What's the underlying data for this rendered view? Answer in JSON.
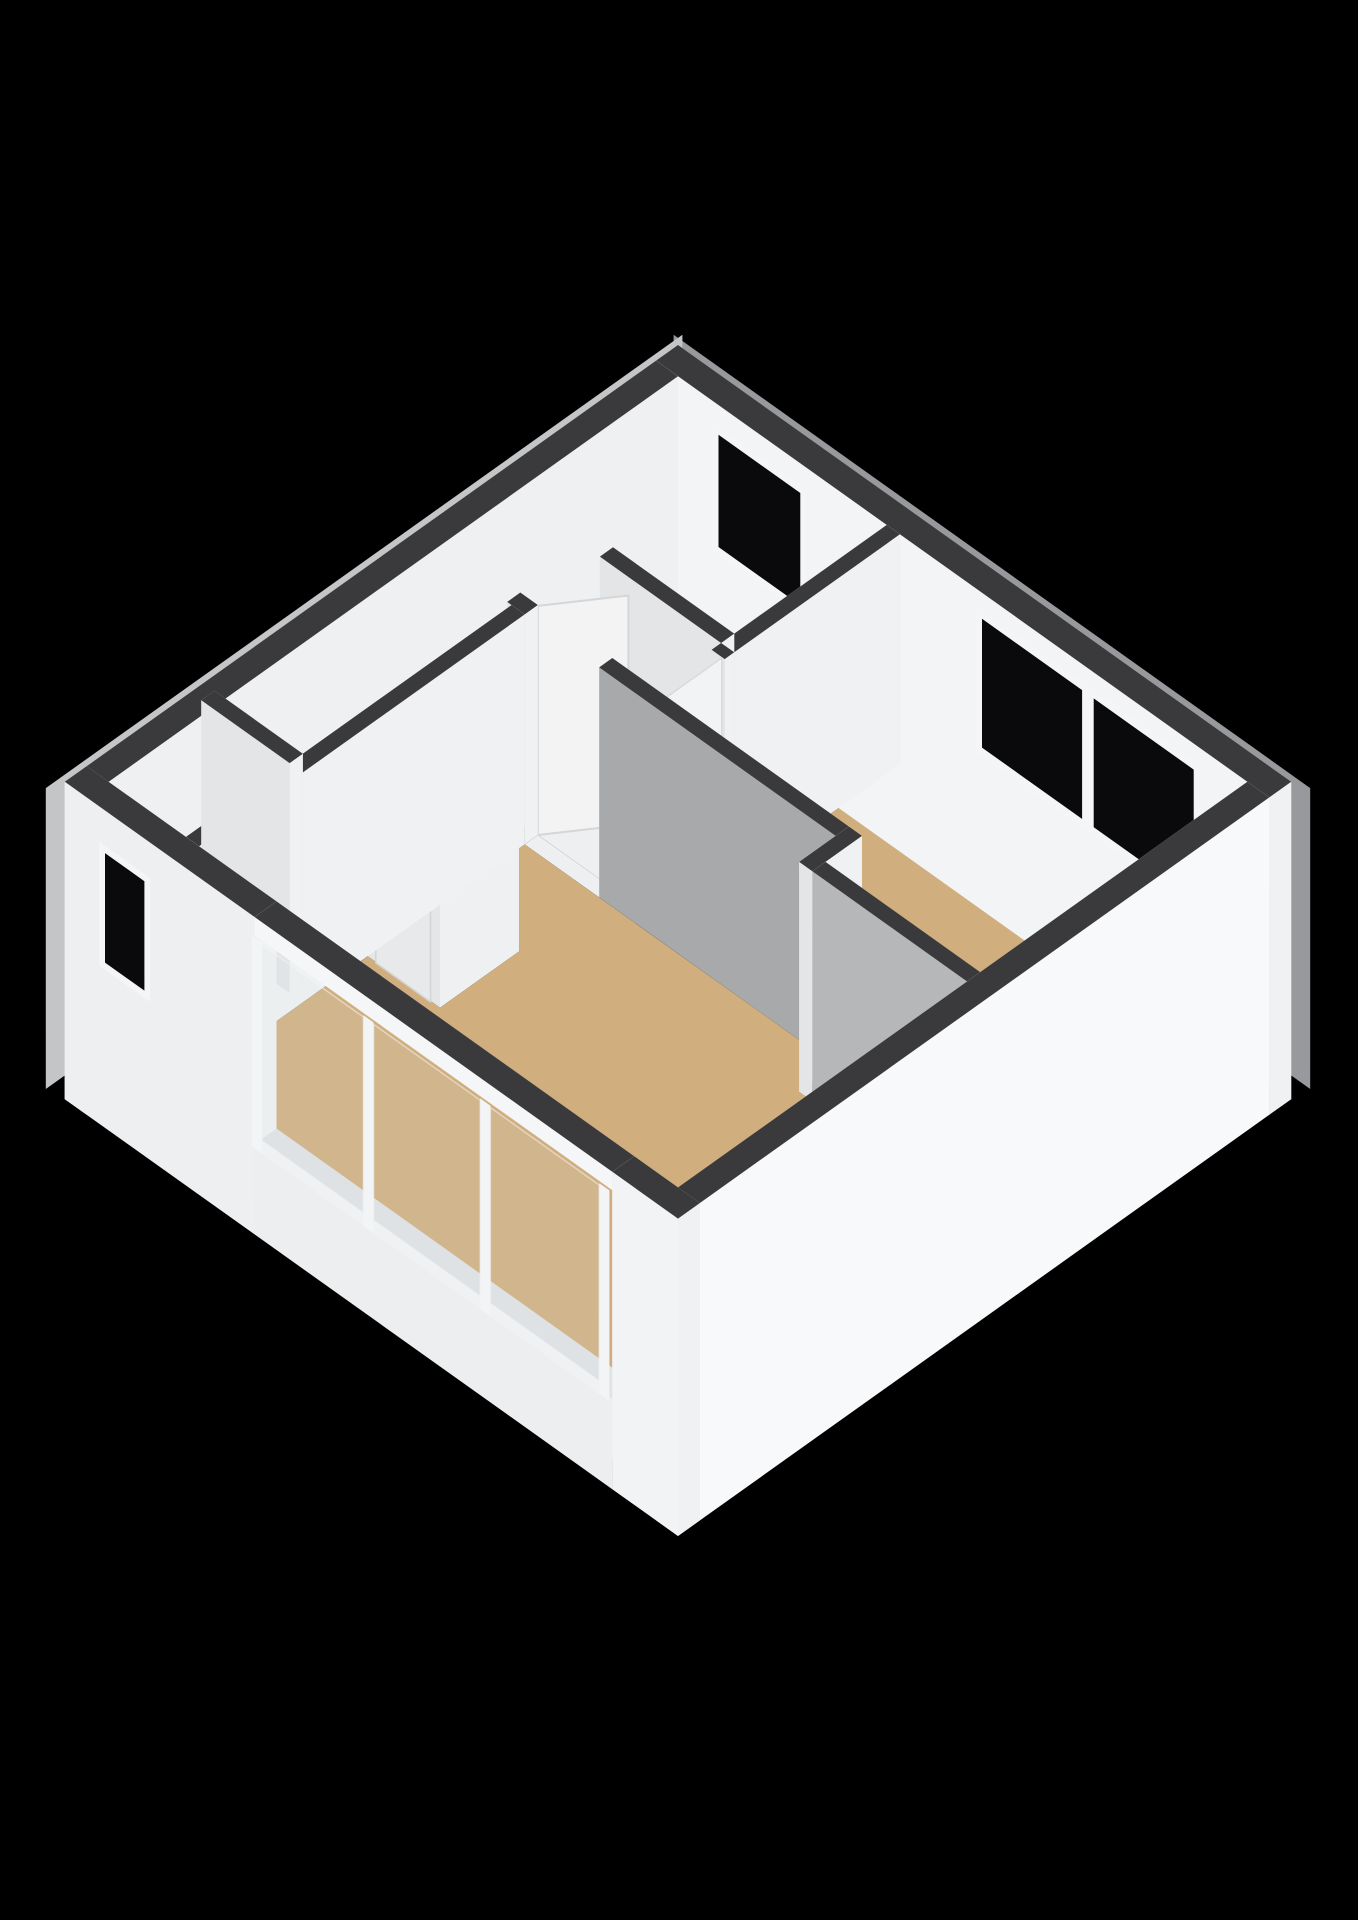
{
  "scene": {
    "canvas": {
      "width": 1358,
      "height": 1920,
      "background": "#000000"
    },
    "projection": {
      "cx": 678,
      "cy": 575,
      "ux": 73,
      "uy": 52,
      "uz": 92
    },
    "palette": {
      "wall_top": "#3a3a3c",
      "face_pa_default": "#f0f1f2",
      "face_pb_default": "#e3e5e7",
      "face_ma_default": "#e8eaec",
      "face_mb_default": "#dfe1e3",
      "floor_wood": "#d1ae7d",
      "floor_bath": "#ccd3db",
      "floor_white": "#edeff0",
      "window_glass": "#0a0a0c",
      "window_frame": "#f4f5f6",
      "exterior_bright": "#f8f9fa",
      "exterior_gray": "#c3c5c7"
    },
    "skirts": [
      {
        "n": "rim-ne",
        "d": 1,
        "plane": "b",
        "c": -0.14,
        "u": [
          -0.2,
          8.52
        ],
        "z": [
          -0.85,
          2.42
        ],
        "fill": "#97999c"
      },
      {
        "n": "rim-nw",
        "d": 2,
        "plane": "a",
        "c": -0.14,
        "u": [
          -0.2,
          8.52
        ],
        "z": [
          -0.85,
          2.42
        ],
        "fill": "#c3c5c7"
      }
    ],
    "floors": [
      {
        "n": "floor-bathroom",
        "d": 10,
        "fill": "#ccd3db",
        "poly": [
          [
            0.3,
            0.3
          ],
          [
            3.16,
            0.3
          ],
          [
            3.16,
            2.39
          ],
          [
            0.3,
            2.39
          ]
        ]
      },
      {
        "n": "floor-bedroom",
        "d": 11,
        "fill": "#d1ae7d",
        "poly": [
          [
            3.34,
            0.3
          ],
          [
            8.1,
            0.3
          ],
          [
            8.1,
            3.96
          ],
          [
            5.98,
            3.96
          ],
          [
            5.98,
            3.46
          ],
          [
            3.34,
            3.46
          ]
        ]
      },
      {
        "n": "floor-living",
        "d": 12,
        "fill": "#d1ae7d",
        "poly": [
          [
            1.54,
            3.64
          ],
          [
            5.8,
            3.64
          ],
          [
            5.8,
            4.14
          ],
          [
            8.1,
            4.14
          ],
          [
            8.1,
            8.1
          ],
          [
            1.54,
            8.1
          ],
          [
            1.54,
            5.79
          ],
          [
            2.53,
            5.79
          ],
          [
            2.53,
            4.71
          ],
          [
            1.54,
            4.71
          ]
        ]
      },
      {
        "n": "floor-hall",
        "d": 13,
        "fill": "#edeff0",
        "poly": [
          [
            1.36,
            2.57
          ],
          [
            3.16,
            2.57
          ],
          [
            3.16,
            3.46
          ],
          [
            1.36,
            3.46
          ]
        ]
      },
      {
        "n": "floor-toilet",
        "d": 14,
        "fill": "#edeff0",
        "poly": [
          [
            0.3,
            2.57
          ],
          [
            1.36,
            2.57
          ],
          [
            1.36,
            3.46
          ],
          [
            0.3,
            3.46
          ]
        ]
      },
      {
        "n": "floor-corridor",
        "d": 15,
        "fill": "#edeff0",
        "poly": [
          [
            0.3,
            3.64
          ],
          [
            1.36,
            3.64
          ],
          [
            1.36,
            6.5
          ],
          [
            0.3,
            6.5
          ]
        ]
      },
      {
        "n": "floor-closet",
        "d": 16,
        "fill": "#eaecee",
        "poly": [
          [
            0.3,
            6.68
          ],
          [
            1.36,
            6.68
          ],
          [
            1.36,
            8.1
          ],
          [
            0.3,
            8.1
          ]
        ]
      },
      {
        "n": "floor-doorway-bath",
        "d": 17,
        "fill": "#edeff0",
        "poly": [
          [
            0.6,
            2.39
          ],
          [
            1.5,
            2.39
          ],
          [
            1.5,
            2.57
          ],
          [
            0.6,
            2.57
          ]
        ]
      },
      {
        "n": "floor-doorway-living",
        "d": 18,
        "fill": "#edeff0",
        "poly": [
          [
            1.54,
            3.46
          ],
          [
            2.56,
            3.46
          ],
          [
            2.56,
            3.64
          ],
          [
            1.54,
            3.64
          ]
        ]
      },
      {
        "n": "floor-doorway-toilet",
        "d": 19,
        "fill": "#edeff0",
        "poly": [
          [
            0.45,
            3.46
          ],
          [
            1.3,
            3.46
          ],
          [
            1.3,
            3.64
          ],
          [
            0.45,
            3.64
          ]
        ]
      },
      {
        "n": "floor-doorway-bedroom",
        "d": 19.5,
        "fill": "#edeff0",
        "poly": [
          [
            3.16,
            2.7
          ],
          [
            3.34,
            2.7
          ],
          [
            3.34,
            3.46
          ],
          [
            3.16,
            3.46
          ]
        ]
      }
    ],
    "prisms": [
      {
        "n": "shower-tray",
        "d": 127.5,
        "r": [
          0.32,
          1.38,
          1.42,
          2.38
        ],
        "z": [
          0,
          0.07
        ],
        "c": {
          "top": "#eff1f3",
          "pa": "#e2e4e6",
          "pb": "#dddfe1"
        }
      },
      {
        "n": "shower-seat",
        "d": 128,
        "r": [
          1.0,
          1.34,
          2.0,
          2.34
        ],
        "z": [
          0,
          0.38
        ],
        "c": {
          "top": "#fafbfc",
          "pa": "#f0f2f3",
          "pb": "#e9ebed"
        }
      },
      {
        "n": "wall-bath-hall-west",
        "d": 129,
        "r": [
          0.3,
          0.6,
          2.39,
          2.57
        ],
        "z": [
          0,
          2.5
        ]
      },
      {
        "n": "toilet-cistern",
        "d": 136.4,
        "r": [
          0.35,
          1.3,
          2.66,
          2.98
        ],
        "z": [
          0,
          0.72
        ],
        "c": {
          "top": "#f7f8f9",
          "pa": "#eef0f1",
          "pb": "#e6e8ea"
        }
      },
      {
        "n": "wall-toilet-sw-west",
        "d": 139,
        "r": [
          0.3,
          0.45,
          3.46,
          3.64
        ],
        "z": [
          0,
          2.5
        ]
      },
      {
        "n": "wall-toilet-hall",
        "d": 142.1,
        "r": [
          1.36,
          1.54,
          2.57,
          2.95
        ],
        "z": [
          0,
          2.5
        ]
      },
      {
        "n": "wall-ext-ne",
        "d": 143.5,
        "r": [
          0,
          8.4,
          0,
          0.3
        ],
        "z": [
          -0.95,
          2.5
        ],
        "c": {
          "pb": "#f3f4f6"
        }
      },
      {
        "n": "wall-ext-nw",
        "d": 145,
        "r": [
          0,
          0.3,
          0.3,
          8.4
        ],
        "z": [
          -0.95,
          2.5
        ],
        "c": {
          "pa": "#eff0f1"
        }
      },
      {
        "n": "wall-bath-bedroom",
        "d": 146.85,
        "r": [
          3.16,
          3.34,
          0.3,
          2.57
        ],
        "z": [
          0,
          2.5
        ]
      },
      {
        "n": "wall-bath-hall-east",
        "d": 148,
        "r": [
          1.5,
          3.16,
          2.39,
          2.57
        ],
        "z": [
          0,
          2.5
        ]
      },
      {
        "n": "wall-hall-living-jamb",
        "d": 149.7,
        "r": [
          1.3,
          1.54,
          3.46,
          3.64
        ],
        "z": [
          0,
          2.5
        ]
      },
      {
        "n": "wall-bedroom-hall",
        "d": 158.8,
        "r": [
          3.16,
          3.34,
          2.57,
          2.7
        ],
        "z": [
          0,
          2.5
        ]
      },
      {
        "n": "closet2-box",
        "d": 172.85,
        "r": [
          1.54,
          2.53,
          4.71,
          5.79
        ],
        "z": [
          0,
          2.5
        ],
        "c": {
          "pa": "#eff0f1",
          "pb": "#e4e6e7"
        }
      },
      {
        "n": "wall-corridor-living",
        "d": 173.2,
        "r": [
          1.36,
          1.54,
          3.64,
          8.1
        ],
        "z": [
          0,
          2.5
        ]
      },
      {
        "n": "wall-closet1-ne",
        "d": 173.45,
        "r": [
          0.15,
          1.36,
          6.5,
          6.68
        ],
        "z": [
          0,
          2.5
        ]
      },
      {
        "n": "wall-hall-living-gray",
        "d": 177,
        "r": [
          2.56,
          5.8,
          3.46,
          3.64
        ],
        "z": [
          0,
          2.5
        ],
        "c": {
          "pb": "#a7a9ab"
        }
      },
      {
        "n": "wall-ext-sw-west",
        "d": 195.5,
        "r": [
          0,
          2.6,
          8.1,
          8.4
        ],
        "z": [
          -0.95,
          2.5
        ],
        "c": {
          "pb": "#edeff0"
        }
      },
      {
        "n": "wall-step-connector",
        "d": 196.9,
        "r": [
          5.8,
          5.98,
          3.46,
          4.14
        ],
        "z": [
          0,
          2.5
        ],
        "c": {
          "ma": "#eef0f1"
        }
      },
      {
        "n": "wall-bedroom-living",
        "d": 210.9,
        "r": [
          5.98,
          8.1,
          3.96,
          4.14
        ],
        "z": [
          0,
          2.5
        ],
        "c": {
          "pb": "#b5b7b9"
        }
      },
      {
        "n": "wall-ext-se",
        "d": 226,
        "r": [
          8.1,
          8.4,
          0.3,
          8.4
        ],
        "z": [
          -0.95,
          2.5
        ],
        "c": {
          "pa": "#f8f9fa",
          "ma": "#eff0f1"
        }
      },
      {
        "n": "wall-ext-sw-base",
        "d": 233,
        "r": [
          2.6,
          7.5,
          8.1,
          8.4
        ],
        "z": [
          -0.95,
          0.03
        ],
        "c": {
          "pb": "#eceeef",
          "top": "#e0e2e4"
        }
      },
      {
        "n": "wall-ext-sw-lintel",
        "d": 233.2,
        "r": [
          2.6,
          7.5,
          8.1,
          8.4
        ],
        "z": [
          2.3,
          2.5
        ],
        "c": {
          "pb": "#f5f6f7"
        }
      },
      {
        "n": "wall-ext-sw-east",
        "d": 262,
        "r": [
          7.5,
          8.4,
          8.1,
          8.4
        ],
        "z": [
          -0.95,
          2.5
        ],
        "c": {
          "pb": "#f2f3f4"
        }
      }
    ],
    "glass": [
      {
        "n": "shower-glass-sw",
        "d": 132,
        "plane": "b",
        "c": 2.35,
        "u": [
          0.35,
          1.35
        ],
        "z": [
          0.04,
          2.1
        ],
        "fill": "rgba(200,212,221,0.45)",
        "stroke": "#e8eaec"
      },
      {
        "n": "shower-glass-se",
        "d": 132.5,
        "plane": "a",
        "c": 1.35,
        "u": [
          1.45,
          2.35
        ],
        "z": [
          0.04,
          2.1
        ],
        "fill": "rgba(188,200,210,0.5)",
        "stroke": "#e8eaec"
      }
    ],
    "windows": [
      {
        "n": "window-bathroom",
        "d": 143.8,
        "plane": "b",
        "c": 0.285,
        "u": [
          0.75,
          2.05
        ],
        "z": [
          0.85,
          2.25
        ],
        "f": 0.09
      },
      {
        "n": "window-bedroom",
        "d": 143.9,
        "plane": "b",
        "c": 0.285,
        "u": [
          4.35,
          7.45
        ],
        "z": [
          0.7,
          2.3
        ],
        "f": 0.1,
        "mull": [
          [
            5.82,
            5.98
          ]
        ]
      },
      {
        "n": "window-closet",
        "d": 196,
        "plane": "b",
        "c": 8.43,
        "u": [
          0.5,
          1.2
        ],
        "z": [
          0.8,
          2.15
        ],
        "f": 0.08
      }
    ],
    "glazing": [
      {
        "n": "glazing-bottom-rail",
        "d": 234,
        "plane": "b",
        "c": 8.44,
        "u": [
          2.6,
          7.5
        ],
        "z": [
          0.03,
          0.17
        ],
        "fill": "#eff1f2"
      },
      {
        "n": "glazing-post",
        "d": 234.5,
        "plane": "b",
        "c": 8.44,
        "u": [
          2.6,
          2.74
        ],
        "z": [
          0.03,
          2.32
        ],
        "fill": "#f3f4f5"
      },
      {
        "n": "glazing-post",
        "d": 234.5,
        "plane": "b",
        "c": 8.44,
        "u": [
          4.13,
          4.27
        ],
        "z": [
          0.03,
          2.32
        ],
        "fill": "#f3f4f5"
      },
      {
        "n": "glazing-post",
        "d": 234.5,
        "plane": "b",
        "c": 8.44,
        "u": [
          5.73,
          5.87
        ],
        "z": [
          0.03,
          2.32
        ],
        "fill": "#f3f4f5"
      },
      {
        "n": "glazing-post",
        "d": 234.5,
        "plane": "b",
        "c": 8.44,
        "u": [
          7.36,
          7.5
        ],
        "z": [
          0.03,
          2.32
        ],
        "fill": "#f3f4f5"
      },
      {
        "n": "glazing-pane",
        "d": 235,
        "plane": "b",
        "c": 8.44,
        "u": [
          2.74,
          4.13
        ],
        "z": [
          0.17,
          2.3
        ],
        "fill": "rgba(214,224,233,0.14)",
        "stroke": "rgba(240,244,246,0.55)"
      },
      {
        "n": "glazing-pane",
        "d": 235,
        "plane": "b",
        "c": 8.44,
        "u": [
          4.27,
          5.73
        ],
        "z": [
          0.17,
          2.3
        ],
        "fill": "rgba(214,224,233,0.14)",
        "stroke": "rgba(240,244,246,0.55)"
      },
      {
        "n": "glazing-pane",
        "d": 235,
        "plane": "b",
        "c": 8.44,
        "u": [
          5.87,
          7.36
        ],
        "z": [
          0.17,
          2.3
        ],
        "fill": "rgba(214,224,233,0.14)",
        "stroke": "rgba(240,244,246,0.55)"
      }
    ],
    "doors": [
      {
        "n": "door-toilet",
        "d": 144.3,
        "plane": "b",
        "c": 3.6,
        "u": [
          0.45,
          1.3
        ],
        "z": [
          0,
          2.49
        ],
        "fill": "#f2f3f4",
        "stroke": "#d8dadb",
        "handle": {
          "u": 1.14,
          "z": 1.04
        }
      },
      {
        "n": "door-bedroom",
        "d": 163.9,
        "plane": "a",
        "c": 3.3,
        "u": [
          2.7,
          3.46
        ],
        "z": [
          0,
          2.49
        ],
        "fill": "#f2f3f4",
        "stroke": "#d8dadb",
        "handle": {
          "u": 3.32,
          "z": 1.04
        }
      },
      {
        "n": "door-closet2",
        "d": 173.0,
        "plane": "b",
        "c": 5.8,
        "u": [
          1.66,
          2.41
        ],
        "z": [
          0,
          2.49
        ],
        "fill": "#e7e9ea",
        "stroke": "#d2d4d5",
        "handle": {
          "u": 2.26,
          "z": 1.04
        }
      }
    ],
    "panels": [
      {
        "n": "door-living-open",
        "d": 149.1,
        "from": [
          1.54,
          3.46
        ],
        "to": [
          2.06,
          2.74
        ],
        "z": [
          0,
          2.49
        ],
        "fill": "#f3f3f4",
        "stroke": "#d5d6d7"
      }
    ]
  }
}
